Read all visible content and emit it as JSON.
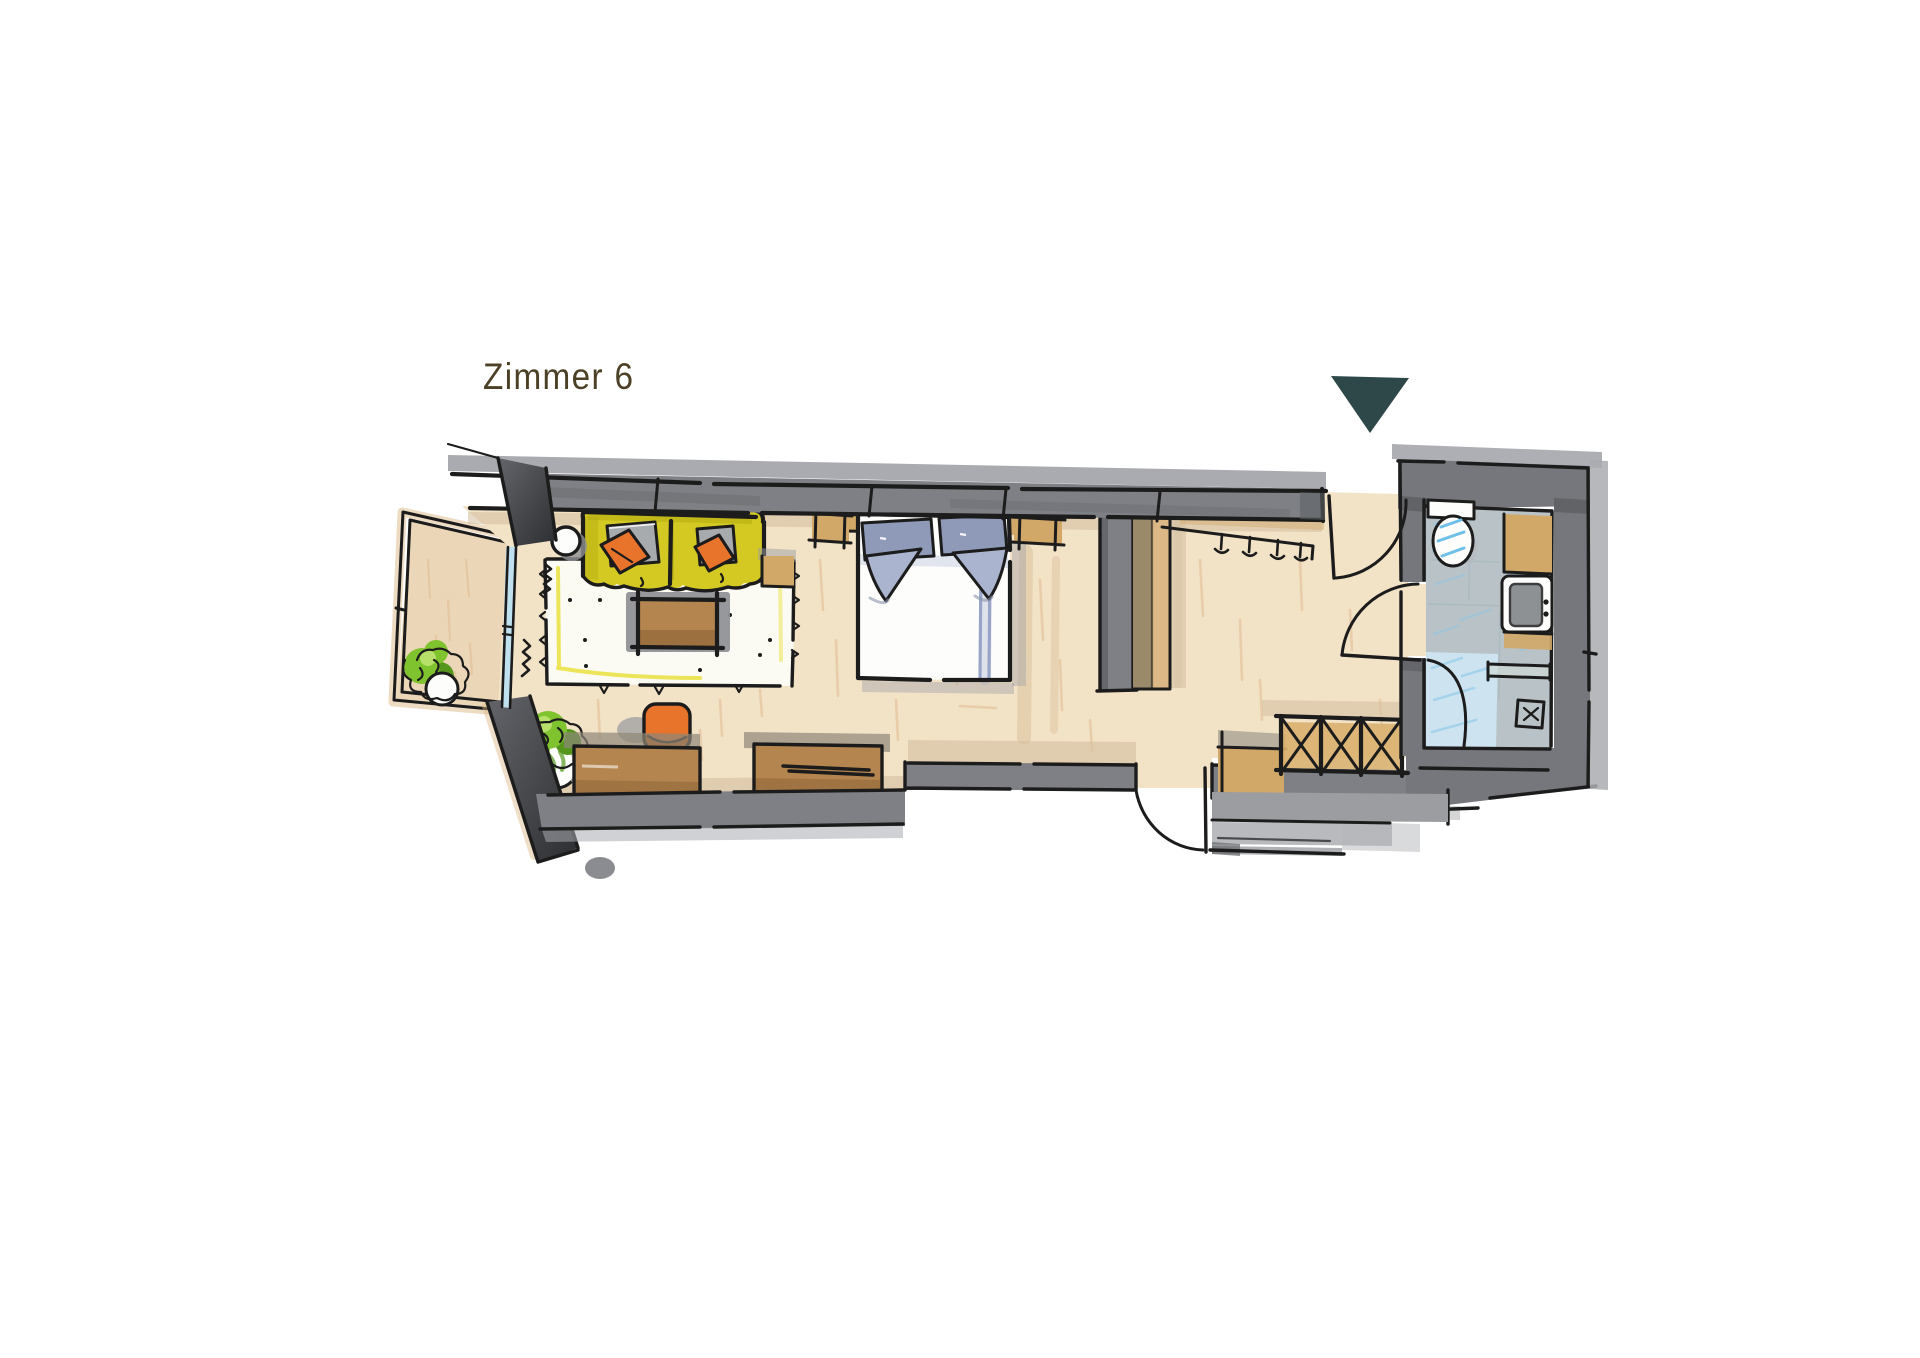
{
  "title": {
    "text": "Zimmer 6",
    "color": "#4c4026"
  },
  "entrance_marker": {
    "label": "entrance",
    "shape": "triangle-down",
    "color": "#2e4849"
  },
  "palette": {
    "ink": "#1c1c1c",
    "wall_gray": "#7e8085",
    "wall_light": "#a9abb0",
    "bath_wall": "#75777c",
    "floor": "#f2e2c6",
    "floor_stroke": "#dfb890",
    "balcony_floor": "#ebd7b7",
    "shadow_warm": "#d5c2a3",
    "rug_white": "#fbfbf4",
    "rug_accent": "#e9e13e",
    "sofa_yellow": "#d3c922",
    "sofa_dark": "#b2aa10",
    "cushion_orange": "#e8732b",
    "cushion_gray": "#a8abae",
    "wood_brown": "#b5854f",
    "wood_dark": "#93673a",
    "wood_tan": "#d2a868",
    "wood_light": "#dbb886",
    "porcelain": "#fdfdfb",
    "pillow_blue": "#8f9ab8",
    "pillow_light": "#aab4ce",
    "runner_blue": "#98a4c8",
    "glass_blue": "#bfe0ee",
    "plant_green": "#7fc32e",
    "plant_dark": "#55961c",
    "plant_light": "#b7e06a",
    "bath_floor": "#b9c3c7",
    "bath_hatch": "#9ec3da",
    "shower_blue": "#cde4f0",
    "shower_hatch": "#a5d4ea",
    "toilet_blue": "#6ec0e8",
    "basin_gray": "#8e9194",
    "step_gray": "#9b9da1",
    "step_light": "#b4b6ba"
  }
}
